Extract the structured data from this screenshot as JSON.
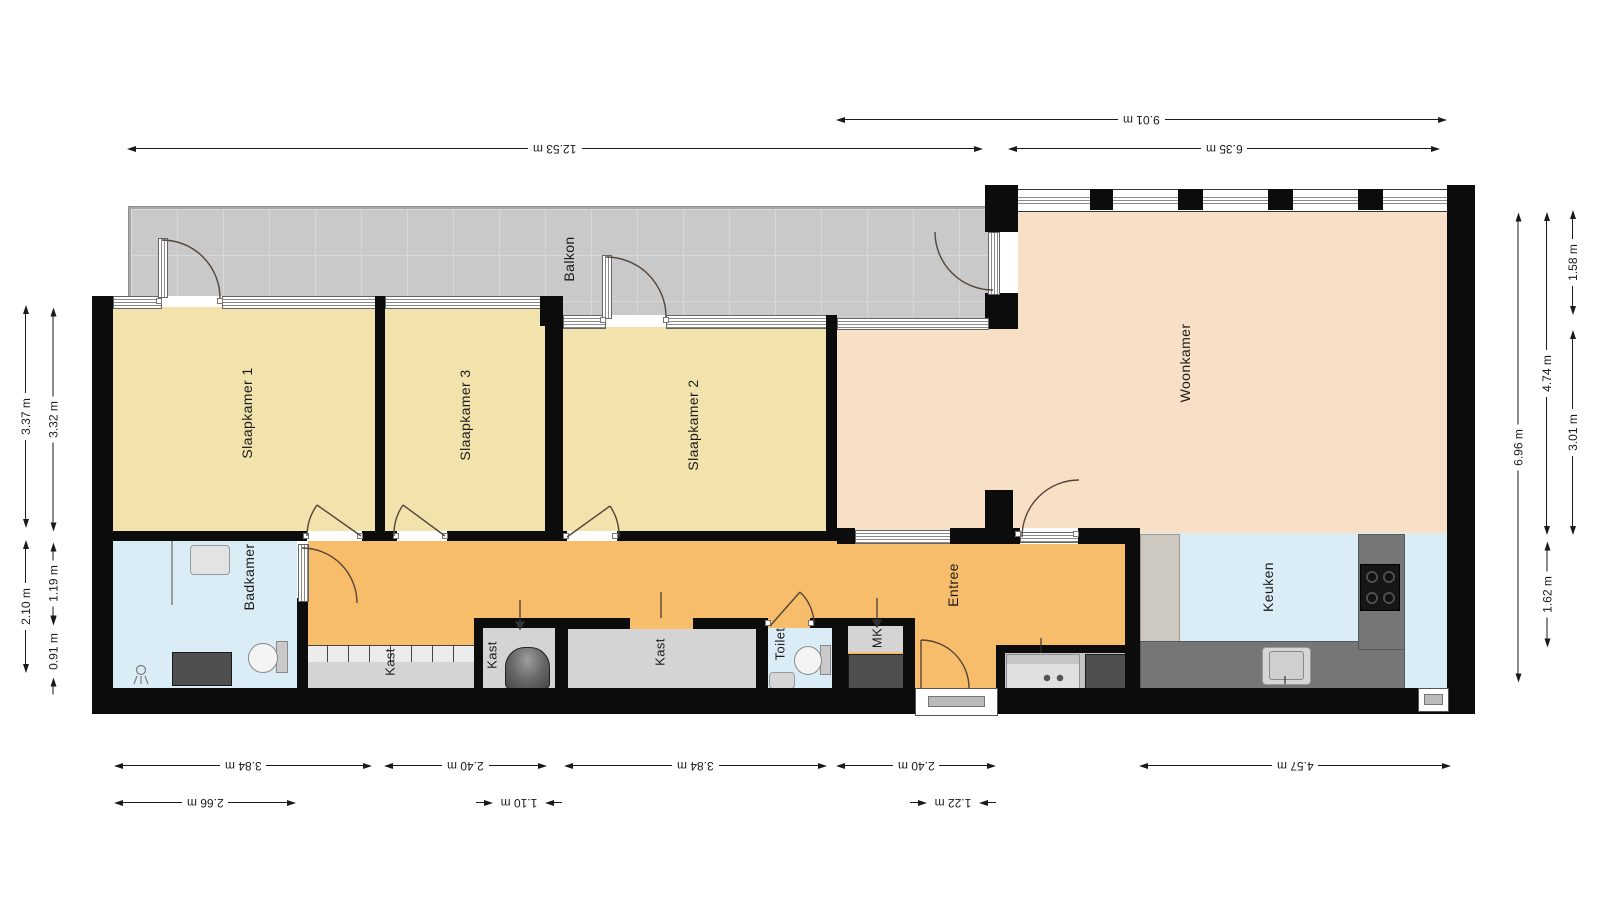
{
  "labels": {
    "slaapkamer_1": "Slaapkamer 1",
    "slaapkamer_2": "Slaapkamer 2",
    "slaapkamer_3": "Slaapkamer 3",
    "woonkamer": "Woonkamer",
    "keuken": "Keuken",
    "badkamer": "Badkamer",
    "balkon": "Balkon",
    "entree": "Entree",
    "toilet": "Toilet",
    "kast": "Kast",
    "mk": "MK"
  },
  "dims": {
    "plan_width": "12.53 m",
    "right_section_width": "9.01 m",
    "woonkamer_width": "6.35 m",
    "sk1_w": "3.84 m",
    "sk3_w": "2.40 m",
    "sk2_w": "3.84 m",
    "entree_w": "2.40 m",
    "keuken_w": "4.57 m",
    "badkamer_w": "2.66 m",
    "kast_w": "1.10 m",
    "voordeur_w": "1.22 m",
    "sk_h": "3.37 m",
    "lower_left_h": "2.10 m",
    "sk_h_inner": "3.32 m",
    "badkamer_h": "1.19 m",
    "shower_h": "0.91 m",
    "right_total_h": "6.96 m",
    "woonkamer_h": "4.74 m",
    "keuken_h": "1.62 m",
    "balkon_d": "1.58 m",
    "woonkamer_lower_h": "3.01 m"
  },
  "colors": {
    "wall": "#0c0c0c",
    "bedroom": "#f2e3ad",
    "living": "#f8e0c6",
    "hallway": "#f7bd6a",
    "wet": "#daecf5",
    "balcony": "#c9c9c9",
    "closet": "#d4d4d4",
    "counter": "#767676",
    "dark": "#4f4f4f"
  }
}
